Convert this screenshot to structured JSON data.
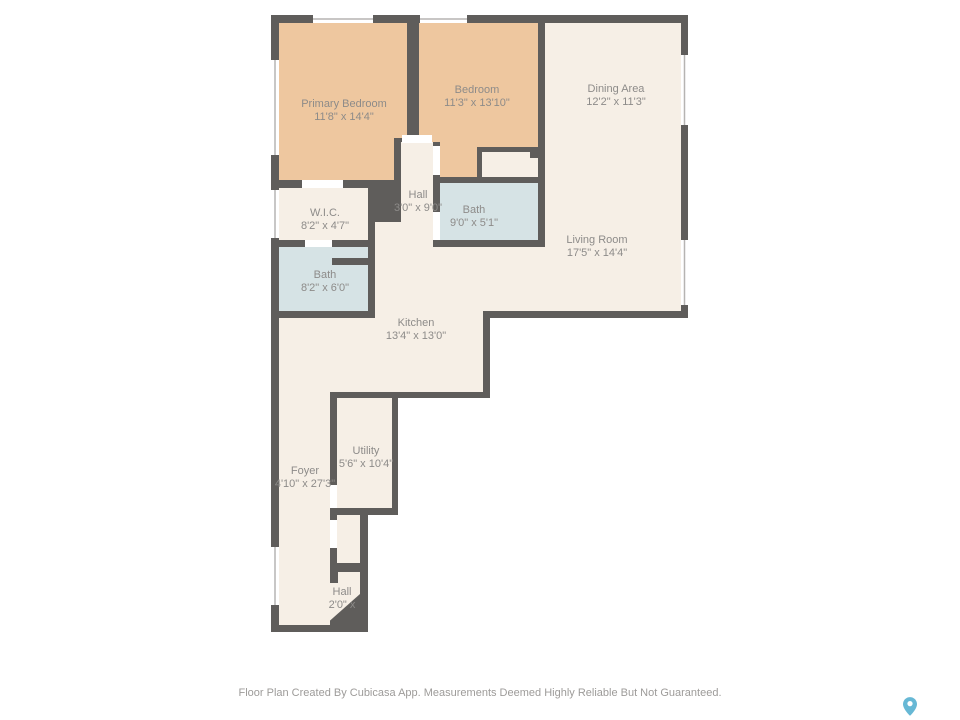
{
  "rooms": [
    {
      "id": "primary-bedroom",
      "name": "Primary Bedroom",
      "dims": "11'8\" x 14'4\""
    },
    {
      "id": "bedroom",
      "name": "Bedroom",
      "dims": "11'3\" x 13'10\""
    },
    {
      "id": "dining-area",
      "name": "Dining Area",
      "dims": "12'2\" x 11'3\""
    },
    {
      "id": "hall-upper",
      "name": "Hall",
      "dims": "3'0\" x 9'0\""
    },
    {
      "id": "bath-upper",
      "name": "Bath",
      "dims": "9'0\" x 5'1\""
    },
    {
      "id": "wic",
      "name": "W.I.C.",
      "dims": "8'2\" x 4'7\""
    },
    {
      "id": "bath-lower",
      "name": "Bath",
      "dims": "8'2\" x 6'0\""
    },
    {
      "id": "living-room",
      "name": "Living Room",
      "dims": "17'5\" x 14'4\""
    },
    {
      "id": "kitchen",
      "name": "Kitchen",
      "dims": "13'4\" x 13'0\""
    },
    {
      "id": "utility",
      "name": "Utility",
      "dims": "5'6\" x 10'4\""
    },
    {
      "id": "foyer",
      "name": "Foyer",
      "dims": "4'10\" x 27'3\""
    },
    {
      "id": "hall-lower",
      "name": "Hall",
      "dims": "2'0\" x"
    }
  ],
  "footer": {
    "disclaimer": "Floor Plan Created By Cubicasa App. Measurements Deemed Highly Reliable But Not Guaranteed."
  },
  "icons": {
    "brand_pin": "location-pin"
  },
  "colors": {
    "wall": "#5f5d5b",
    "floor_default": "#f6efe6",
    "floor_bedroom": "#eec79f",
    "floor_bath": "#d6e3e5",
    "window": "#ffffff",
    "window_line": "#b6b4b2",
    "label_text": "#8d8b89",
    "brand_accent": "#67b8d5",
    "background": "#ffffff"
  }
}
